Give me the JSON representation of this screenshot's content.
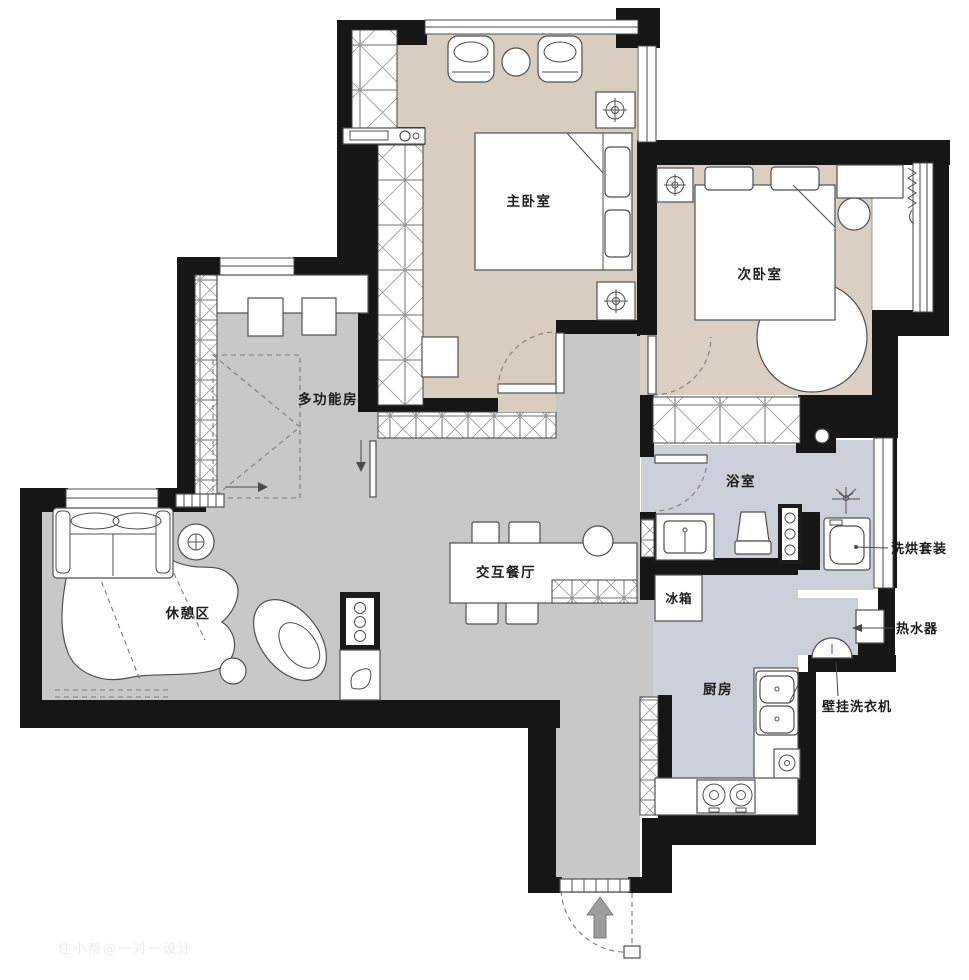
{
  "watermark": "住小帮@一对一设计",
  "colors": {
    "wall": "#161616",
    "floor_bedroom": "#d8cdbf",
    "floor_living": "#c8c8c8",
    "floor_wet": "#ccd0db",
    "furniture_line": "#4f4f4f"
  },
  "rooms": [
    {
      "id": "master-bedroom",
      "label": "主卧室"
    },
    {
      "id": "second-bedroom",
      "label": "次卧室"
    },
    {
      "id": "multi-function-room",
      "label": "多功能房"
    },
    {
      "id": "lounge",
      "label": "休憩区"
    },
    {
      "id": "dining",
      "label": "交互餐厅"
    },
    {
      "id": "bathroom",
      "label": "浴室"
    },
    {
      "id": "kitchen",
      "label": "厨房"
    }
  ],
  "appliances": [
    {
      "id": "fridge",
      "label": "冰箱"
    },
    {
      "id": "washer-dryer",
      "label": "洗烘套装"
    },
    {
      "id": "water-heater",
      "label": "热水器"
    },
    {
      "id": "wall-mounted-washer",
      "label": "壁挂洗衣机"
    }
  ]
}
